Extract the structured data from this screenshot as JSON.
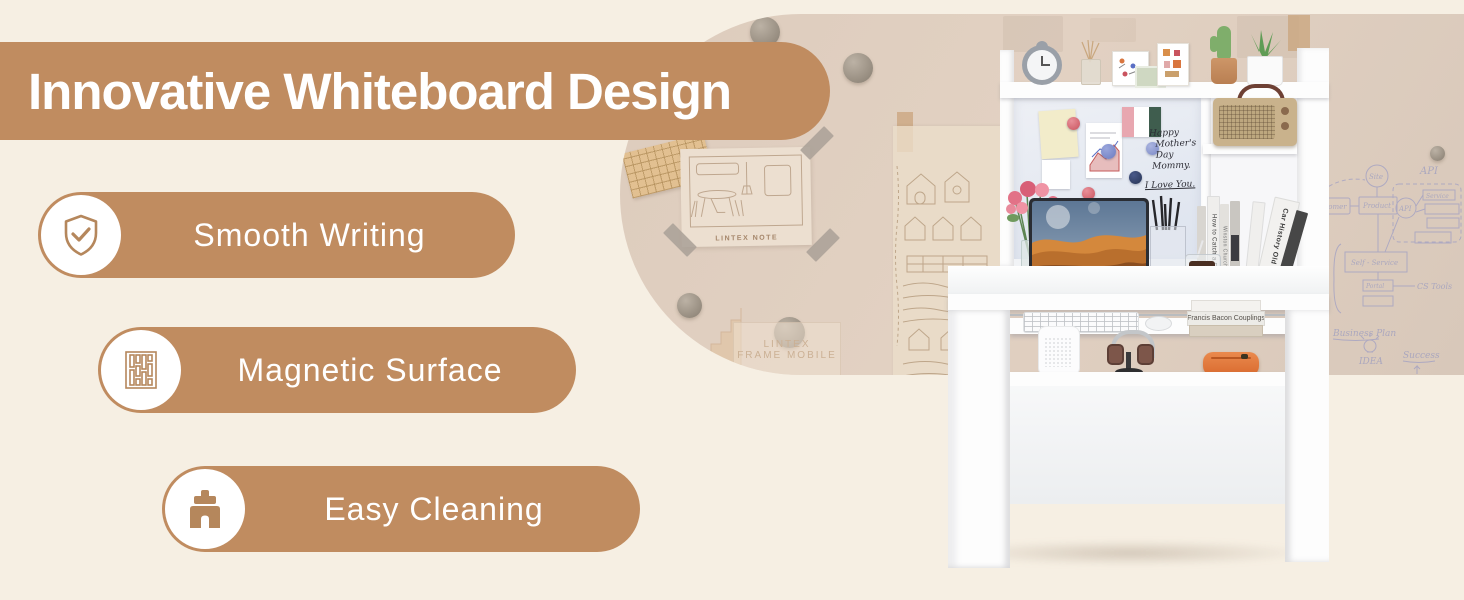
{
  "banner": {
    "title": "Innovative Whiteboard Design"
  },
  "features": [
    {
      "label": "Smooth Writing",
      "icon": "shield-check-icon"
    },
    {
      "label": "Magnetic Surface",
      "icon": "magnetic-surface-icon"
    },
    {
      "label": "Easy Cleaning",
      "icon": "cleaning-brush-icon"
    }
  ],
  "colors": {
    "accent_brown": "#c08c60",
    "background_cream": "#f6efe3",
    "blob_beige": "#dbcabb",
    "whiteboard_blue": "#e9edf4",
    "pouch_orange": "#e0773c"
  },
  "photo": {
    "whiteboard_message": {
      "line1": "Happy",
      "line2": "Mother's Day",
      "line3": "Mommy.",
      "line4": "I Love You."
    },
    "wall_note_caption": "LINTEX NOTE",
    "wall_frame_caption_line1": "LINTEX",
    "wall_frame_caption_line2": "FRAME MOBILE",
    "desk_books": [
      "How to Catch a Fish",
      "Winston Churchill",
      "Car History Old Cars"
    ],
    "tray_book": "Francis Bacon Couplings",
    "sketch": {
      "site": "Site",
      "api": "API",
      "customer": "Customer",
      "product": "Product",
      "self_service": "Self - Service",
      "portal": "Portal",
      "cs_tools": "CS Tools",
      "service": "Service",
      "business_plan": "Business Plan",
      "idea": "IDEA",
      "success": "Success",
      "ppl": "- PPL",
      "seo": "- SEO",
      "pots": "pots"
    }
  }
}
